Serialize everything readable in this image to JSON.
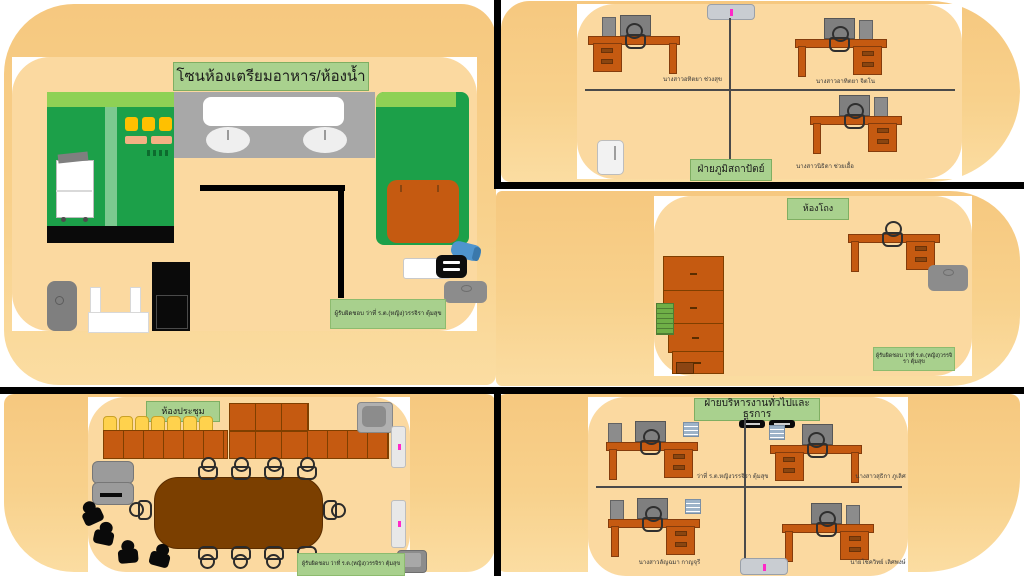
{
  "colors": {
    "background_orange": "#f6c87f",
    "panel_orange": "#fbd9a0",
    "label_green": "#a9d18e",
    "wall_black": "#000000",
    "furniture_brown": "#c55a11",
    "appliance_green": "#1ca049",
    "table_brown": "#7b3f00",
    "accent_pink": "#ff29c8"
  },
  "zones": {
    "food": {
      "title": "โซนห้องเตรียมอาหาร/ห้องน้ำ",
      "responsible": "ผู้รับผิดชอบ  ว่าที่ ร.ต.(หญิง)วรรจิรา ตุ้มสุข"
    },
    "landscape": {
      "title": "ฝ่ายภูมิสถาปัตย์",
      "staff": [
        "นางสาวอทิตยา ช่วงสุข",
        "นางสาวอาทิตยา จิตโน",
        "นางสาวนิธิดา ช่วยเอื้อ"
      ]
    },
    "hall": {
      "title": "ห้องโถง",
      "responsible": "ผู้รับผิดชอบ  ว่าที่ ร.ต.(หญิง)วรรจิรา ตุ้มสุข"
    },
    "meeting": {
      "title": "ห้องประชุม",
      "responsible": "ผู้รับผิดชอบ  ว่าที่ ร.ต.(หญิง)วรรจิรา ตุ้มสุข"
    },
    "admin": {
      "title": "ฝ่ายบริหารงานทั่วไปและธุรการ",
      "staff": [
        "ว่าที่ ร.ต.หญิงวรรจิรา ตุ้มสุข",
        "นางสาวสุธิกา ภูเลิศ",
        "นางสาวลัญฉมา กาญจุรี",
        "นายโชควิทย์ เลิศพงษ์"
      ]
    }
  }
}
